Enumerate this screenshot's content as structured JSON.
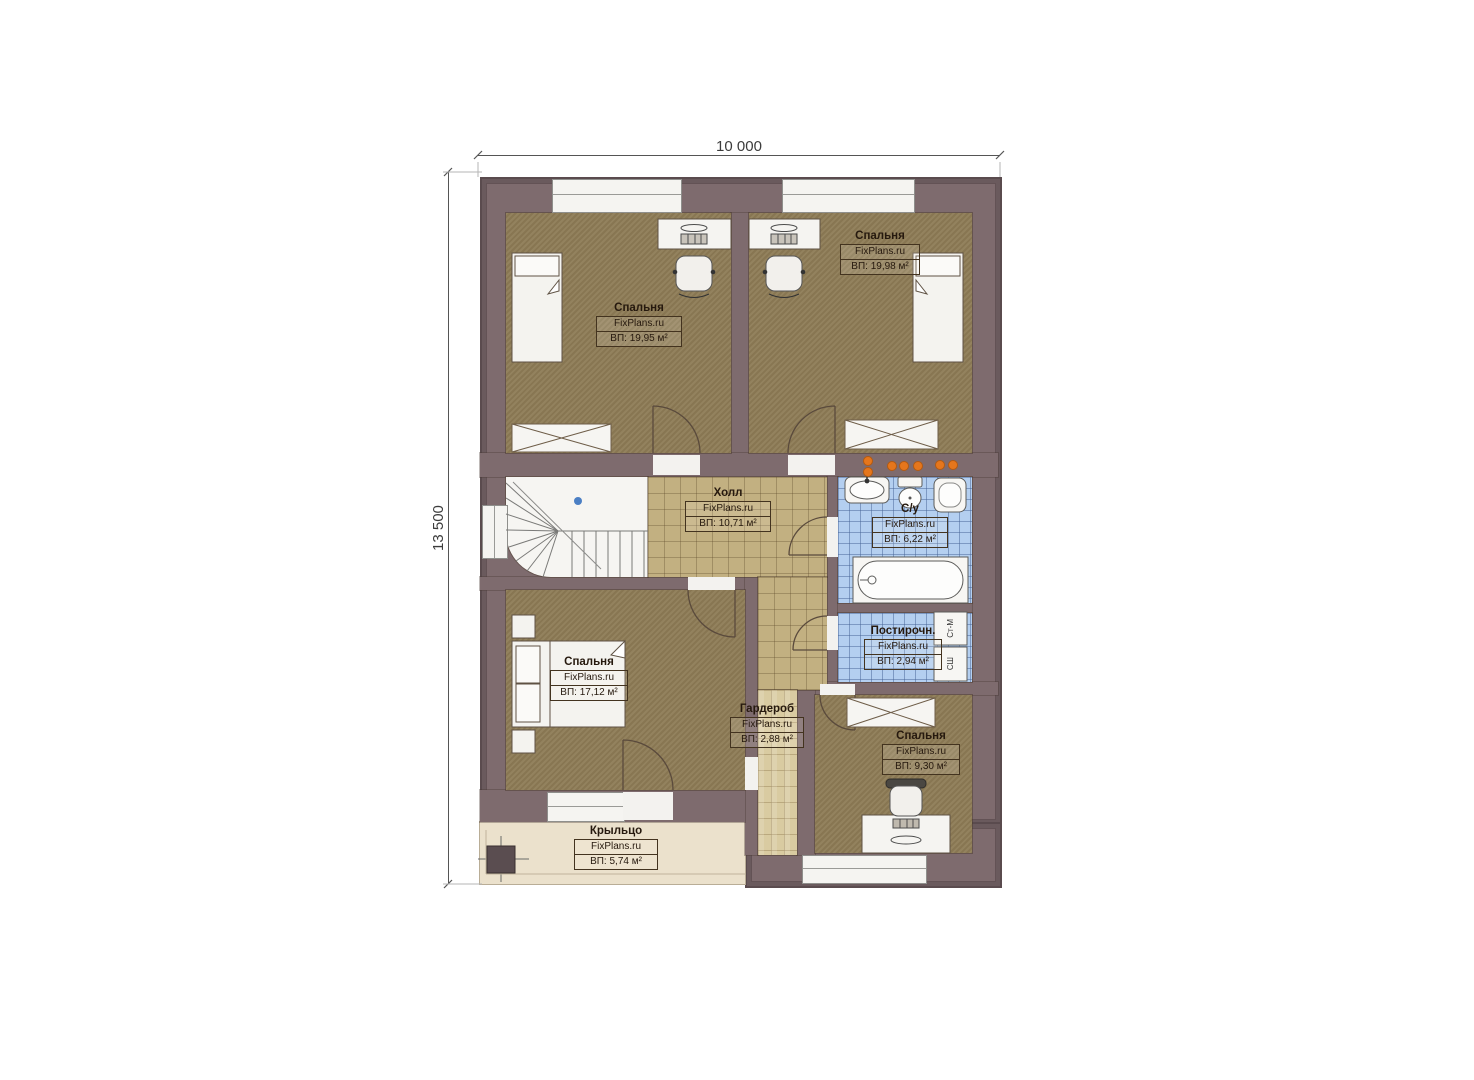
{
  "dimensions": {
    "width": "10 000",
    "height": "13 500"
  },
  "brand": "FixPlans.ru",
  "rooms": [
    {
      "name": "Спальня",
      "area": "ВП: 19,95 м²"
    },
    {
      "name": "Спальня",
      "area": "ВП: 19,98 м²"
    },
    {
      "name": "Холл",
      "area": "ВП: 10,71 м²"
    },
    {
      "name": "С/у",
      "area": "ВП: 6,22 м²"
    },
    {
      "name": "Постирочн.",
      "area": "ВП: 2,94 м²"
    },
    {
      "name": "Спальня",
      "area": "ВП: 17,12 м²"
    },
    {
      "name": "Гардероб",
      "area": "ВП: 2,88 м²"
    },
    {
      "name": "Спальня",
      "area": "ВП: 9,30 м²"
    },
    {
      "name": "Крыльцо",
      "area": "ВП: 5,74 м²"
    }
  ],
  "appliances": {
    "washing_machine": "Ст-М",
    "dryer": "СШ"
  },
  "colors": {
    "wall": "#7e6b6e",
    "wall_outline": "#5a4b4e",
    "bedroom_floor": "#8d7b55",
    "hall_floor": "#c2b081",
    "wet_floor": "#b4cff0",
    "wardrobe_floor": "#d9cba1",
    "porch_floor": "#ebe1cc",
    "accent_orange": "#e5761c",
    "stair_dot_blue": "#4b7fc4"
  }
}
